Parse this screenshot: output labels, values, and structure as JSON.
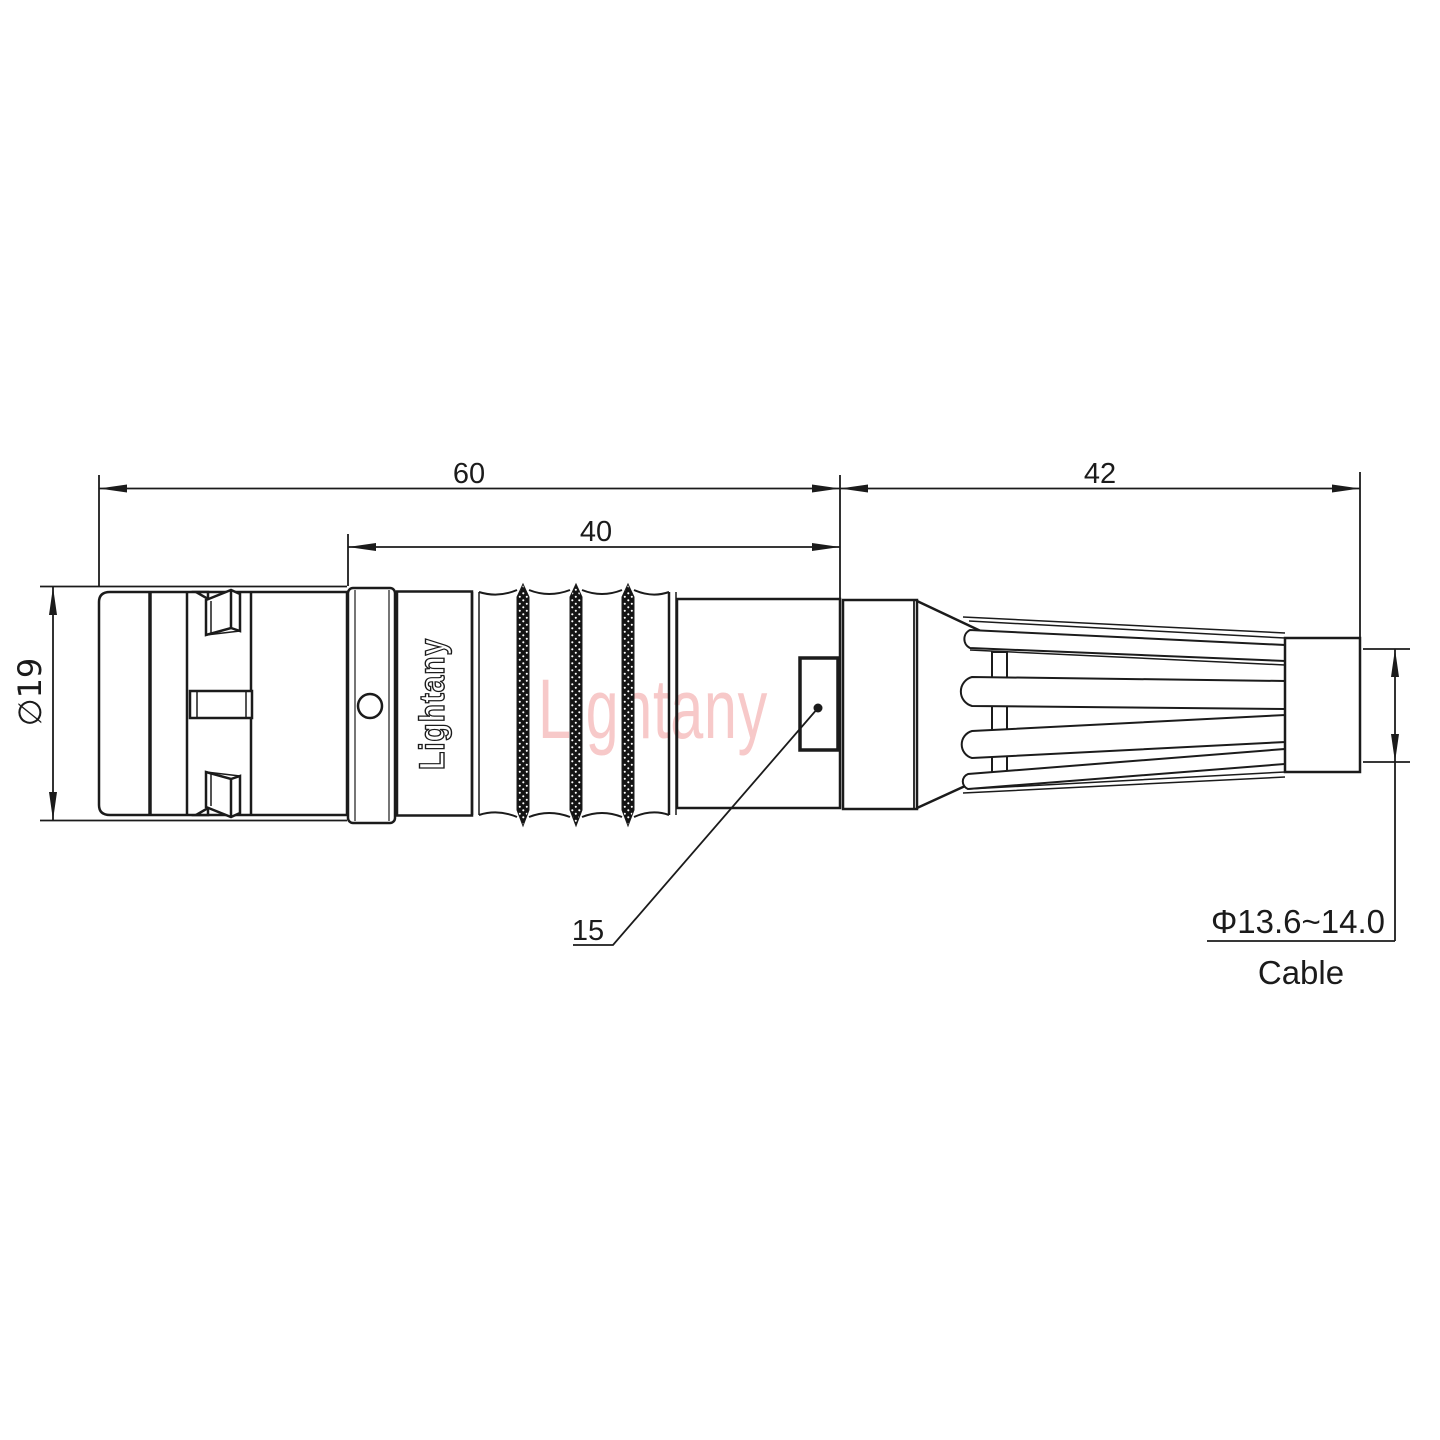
{
  "drawing": {
    "dimensions": {
      "total_length": "60",
      "mid_length": "40",
      "rear_length": "42",
      "front_diameter": "∅19",
      "leader_ref": "15",
      "cable_diameter": "Φ13.6~14.0",
      "cable_label": "Cable"
    },
    "branding": {
      "body_logo": "Lightany",
      "watermark": "Lightany"
    },
    "colors": {
      "line": "#1b1b1b",
      "watermark": "#f7c9c9",
      "background": "#ffffff"
    }
  }
}
